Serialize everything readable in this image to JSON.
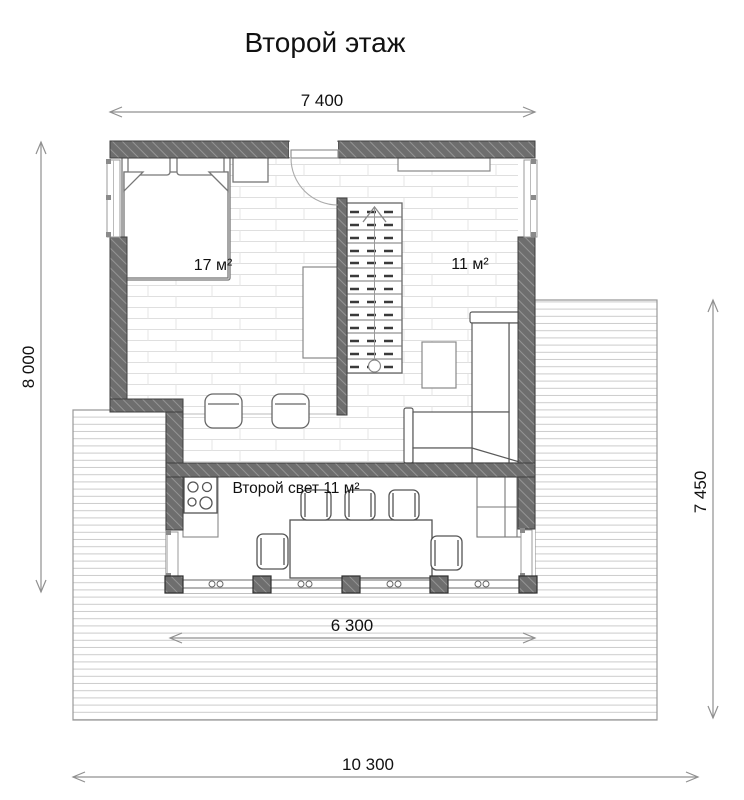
{
  "title": "Второй этаж",
  "dimensions": {
    "top": "7 400",
    "left": "8 000",
    "right": "7 450",
    "terrace": "6 300",
    "bottom": "10 300"
  },
  "rooms": {
    "bedroom": "17 м²",
    "hall": "11 м²",
    "void": "Второй свет 11 м²"
  },
  "colors": {
    "wall_fill": "#6e6e6e",
    "wall_hatch": "#949494",
    "wall_outline": "#3f3f3f",
    "furniture_line": "#5a5a5a",
    "dim_line": "#909090",
    "deck_line": "#cccccc",
    "parquet_line": "#dfdfdf",
    "text": "#111111"
  }
}
